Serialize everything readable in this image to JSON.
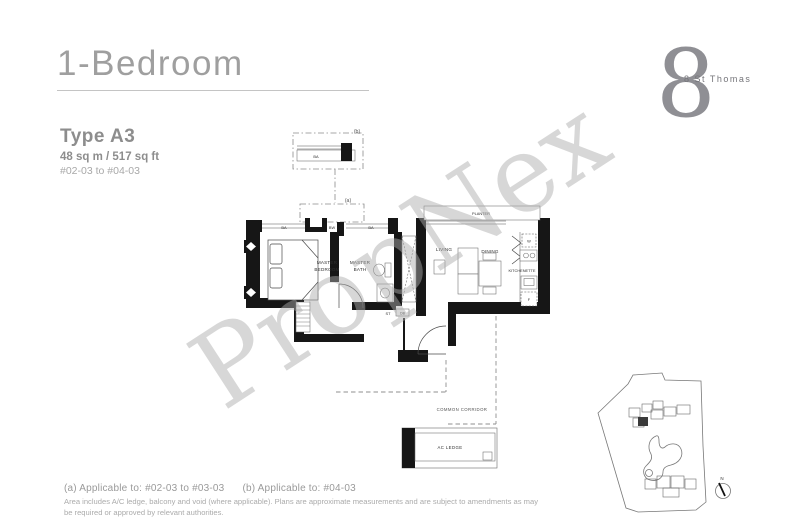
{
  "header": {
    "title": "1-Bedroom",
    "logo_glyph": "8",
    "logo_text": "8 St Thomas"
  },
  "unit_info": {
    "type": "Type A3",
    "area": "48 sq m  / 517 sq ft",
    "units": "#02-03 to #04-03"
  },
  "watermark": "PropNex",
  "floorplan": {
    "markers": {
      "a": "(a)",
      "b": "(b)"
    },
    "labels": {
      "bay_b": "BA",
      "bay_left": "BA",
      "bay_mid": "BW",
      "bay_right": "BA",
      "master_bedroom_1": "MASTER",
      "master_bedroom_2": "BEDROOM",
      "master_bath_1": "MASTER",
      "master_bath_2": "BATH",
      "living": "LIVING",
      "dining": "DINING",
      "kitchenette": "KITCHENETTE",
      "planter": "PLANTER",
      "store": "ST",
      "db": "DB",
      "washer": "W",
      "fridge": "F",
      "common_corridor": "COMMON CORRIDOR",
      "ac_ledge": "AC LEDGE"
    }
  },
  "keyplan": {
    "north": "N"
  },
  "footer": {
    "applicable_a": "(a) Applicable to: #02-03 to #03-03",
    "applicable_b": "(b) Applicable to: #04-03",
    "disclaimer_1": "Area includes A/C ledge, balcony and void (where applicable). Plans are approximate measurements and are subject to amendments as may",
    "disclaimer_2": "be required or approved by relevant authorities."
  },
  "colors": {
    "title_gray": "#9f9f9f",
    "wall_black": "#161616",
    "watermark_gray": "#acacac"
  }
}
